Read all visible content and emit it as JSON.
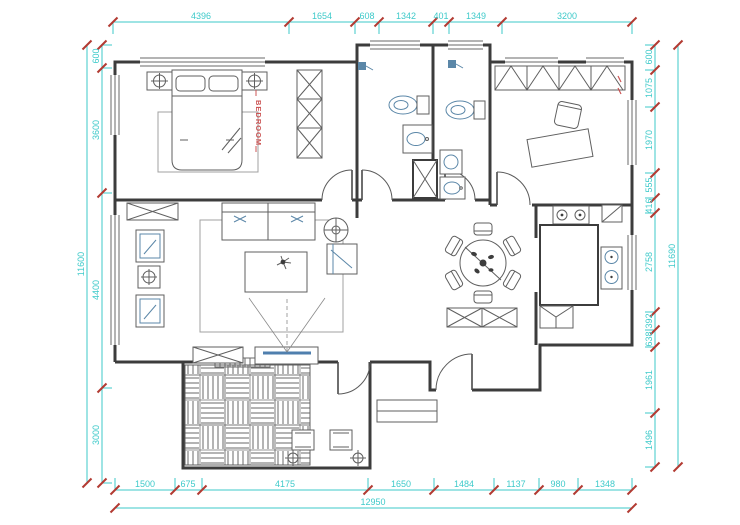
{
  "drawing": {
    "type": "apartment-floor-plan",
    "labels": {
      "bedroom": "BEDROOM"
    },
    "colors": {
      "dimension_cyan": "#3ecaca",
      "tick_red": "#b23a32",
      "wall_gray": "#3c3c3c",
      "fixture_blue": "#5b87a8",
      "label_red": "#cc5555",
      "background": "#ffffff"
    },
    "dimensions": {
      "top": {
        "segments": [
          "4396",
          "1654",
          "608",
          "1342",
          "401",
          "1349",
          "3200"
        ]
      },
      "bottom": {
        "segments": [
          "1500",
          "675",
          "4175",
          "1650",
          "1484",
          "1137",
          "980",
          "1348"
        ],
        "total": "12950"
      },
      "left": {
        "segments": [
          "600",
          "3600",
          "4400",
          "3000"
        ],
        "total": "11600"
      },
      "right": {
        "segments": [
          "600",
          "1075",
          "1970",
          "555",
          "416",
          "2758",
          "392",
          "638",
          "1961",
          "1496"
        ],
        "total": "11690"
      }
    }
  }
}
